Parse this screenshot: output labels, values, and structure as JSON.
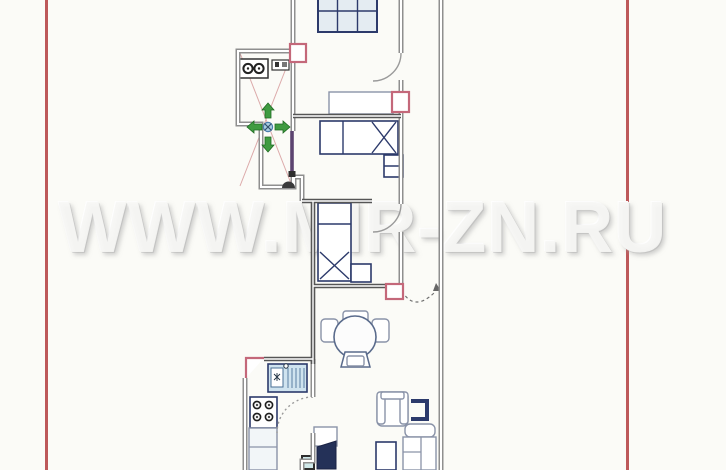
{
  "watermark": {
    "text": "WWW.MIR-ZN.RU"
  },
  "frame": {
    "left_line_x": 46,
    "right_line_x": 627
  },
  "colors": {
    "background": "#fbfbf7",
    "frame": "#b23c3e",
    "walls": "#8f8f8f",
    "walls_dark": "#565656",
    "furniture_outline": "#2c3a6b",
    "furniture_light": "#cfe3ef",
    "vent_marker": "#c4687a",
    "arrow_green": "#3f9b41",
    "center_marker_blue": "#a9cde2",
    "door_purple": "#5c4470",
    "tv_navy": "#243158"
  },
  "plan": {
    "type": "apartment-floor-plan-scan",
    "rooms": [
      "top-room",
      "entry-hall",
      "small-bedroom",
      "main-bedroom",
      "dining-area",
      "kitchen",
      "living-area",
      "balcony-strip"
    ],
    "furniture": [
      "grid-wardrobe",
      "top-room-sofa",
      "washing-machine",
      "hall-shelf",
      "bed-horizontal",
      "nightstand-1",
      "bed-vertical",
      "nightstand-2",
      "round-dining-table",
      "dining-chairs",
      "kitchen-sink-unit",
      "stove-four-burner",
      "kitchen-counter",
      "armchair",
      "tv-shelf-bracket",
      "sofa",
      "coffee-table",
      "tv-set",
      "teal-box"
    ],
    "markers": [
      "vent-marker-top",
      "vent-marker-right",
      "vent-marker-bottom",
      "vent-corner-kitchen",
      "ceiling-point-green-arrows",
      "entry-door-mark",
      "purple-door-leaf",
      "balcony-door-swing-dashed"
    ],
    "green_arrows": {
      "count": 4,
      "directions": [
        "up",
        "down",
        "left",
        "right"
      ]
    }
  }
}
